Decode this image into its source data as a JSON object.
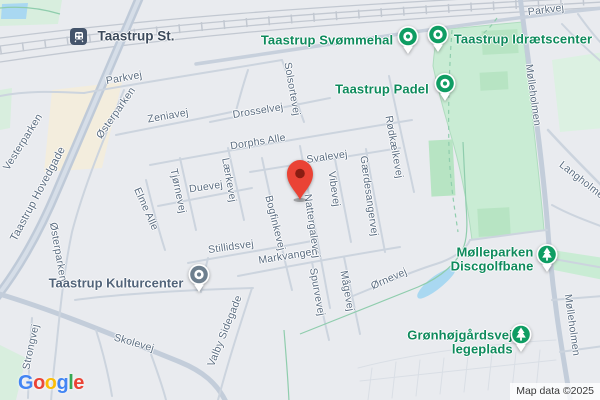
{
  "station": {
    "label": "Taastrup St."
  },
  "marker": {
    "color": "#EA4335",
    "dot_color": "#8A1D12"
  },
  "colors": {
    "poi_green": "#0F9D63",
    "poi_text_green": "#0E8A5C",
    "civic_gray": "#6E7F8E",
    "street_label": "#5A6C80",
    "park_green": "#C9ECD4",
    "water_blue": "#A9D8F1",
    "marker_red": "#EA4335"
  },
  "streets": {
    "parkvej_w": "Parkvej",
    "parkvej_e": "Parkvej",
    "zeniavej": "Zeniavej",
    "drosselvej": "Drosselvej",
    "solsortevej": "Solsortevej",
    "dorphs_alle": "Dorphs Alle",
    "svalevej": "Svalevej",
    "duevej": "Duevej",
    "tjornevej": "Tjørnevej",
    "laerkevej": "Lærkevej",
    "elme_alle": "Elme Alle",
    "bogfinkevej": "Bogfinkevej",
    "nattergalevej": "Nattergalevej",
    "vibevej": "Vibevej",
    "gaerdesangervej": "Gærdesangervej",
    "rodkaelkevej": "Rødkælkevej",
    "stillidsvej": "Stillidsvej",
    "markvangen": "Markvangen",
    "spurvevej": "Spurvevej",
    "maagevej": "Mågevej",
    "ornevej": "Ørnevej",
    "skolevej": "Skolevej",
    "strongvej": "Strongvej",
    "valby_sidegade": "Valby Sidegade",
    "osterparken_n": "Østerparken",
    "osterparken_s": "Østerparken",
    "vesterparken": "Vesterparken",
    "hovedgade": "Taastrup Hovedgade",
    "molleholmen_n": "Mølleholmen",
    "molleholmen_s": "Mølleholmen",
    "langholmen": "Langholmen"
  },
  "pois": {
    "svommehal": {
      "label": "Taastrup Svømmehal"
    },
    "idraetscenter": {
      "label": "Taastrup Idrætscenter"
    },
    "padel": {
      "label": "Taastrup Padel"
    },
    "kulturcenter": {
      "label": "Taastrup Kulturcenter"
    },
    "discgolf": {
      "line1": "Mølleparken",
      "line2": "Discgolfbane"
    },
    "legeplads": {
      "line1": "Grønhøjgårdsvej",
      "line2": "legeplads"
    }
  },
  "logo": {
    "letters": [
      {
        "ch": "G",
        "color": "#4285F4"
      },
      {
        "ch": "o",
        "color": "#EA4335"
      },
      {
        "ch": "o",
        "color": "#FBBC05"
      },
      {
        "ch": "g",
        "color": "#4285F4"
      },
      {
        "ch": "l",
        "color": "#34A853"
      },
      {
        "ch": "e",
        "color": "#EA4335"
      }
    ]
  },
  "attribution": {
    "text": "Map data ©2025"
  }
}
